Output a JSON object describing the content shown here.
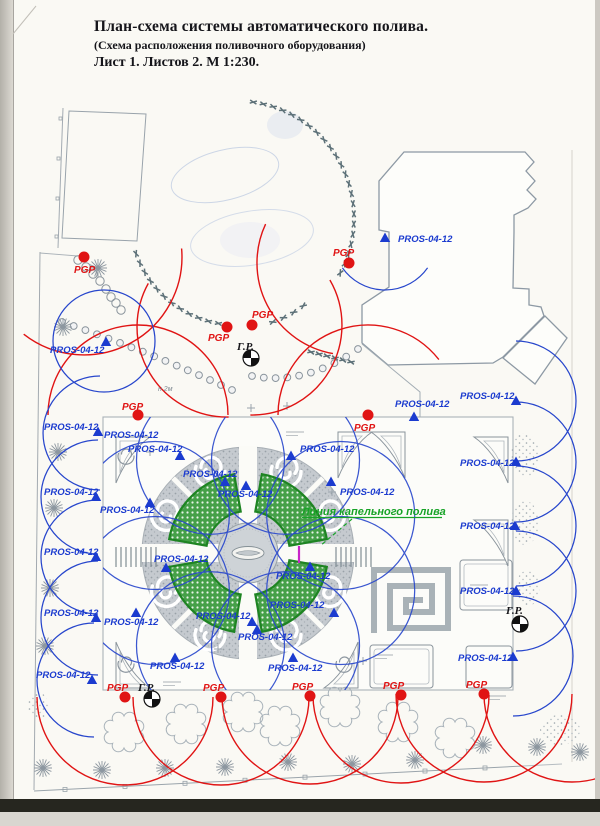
{
  "title": {
    "line1": "План-схема системы автоматического полива.",
    "line2": "(Схема расположения поливочного оборудования)",
    "line3": "Лист 1. Листов 2. М 1:230."
  },
  "labels": {
    "spray": "PROS-04-12",
    "rotor": "PGP",
    "hydrant": "Г.Р.",
    "drip": "Линия капельного полива",
    "hedge_note": "н 2м"
  },
  "colors": {
    "spray_blue": "#1b3bcf",
    "arc_blue": "#2746cc",
    "rotor_red": "#e01414",
    "drip_green": "#17a327",
    "hydrant_black": "#111111",
    "magenta": "#c824c8"
  },
  "markers": {
    "spray_heads": [
      {
        "x": 385,
        "y": 238,
        "lx": 398,
        "ly": 242
      },
      {
        "x": 106,
        "y": 342,
        "lx": 50,
        "ly": 353
      },
      {
        "x": 98,
        "y": 432,
        "lx": 44,
        "ly": 430
      },
      {
        "x": 96,
        "y": 497,
        "lx": 44,
        "ly": 495
      },
      {
        "x": 96,
        "y": 557,
        "lx": 44,
        "ly": 555
      },
      {
        "x": 96,
        "y": 618,
        "lx": 44,
        "ly": 616
      },
      {
        "x": 92,
        "y": 680,
        "lx": 36,
        "ly": 678
      },
      {
        "x": null,
        "y": null,
        "lx": 104,
        "ly": 438
      },
      {
        "x": 180,
        "y": 456,
        "lx": 128,
        "ly": 452
      },
      {
        "x": 225,
        "y": 482,
        "lx": 183,
        "ly": 477
      },
      {
        "x": 246,
        "y": 486,
        "lx": 218,
        "ly": 497
      },
      {
        "x": 291,
        "y": 456,
        "lx": 300,
        "ly": 452
      },
      {
        "x": 331,
        "y": 482,
        "lx": 340,
        "ly": 495
      },
      {
        "x": 150,
        "y": 503,
        "lx": 100,
        "ly": 513
      },
      {
        "x": 166,
        "y": 568,
        "lx": 154,
        "ly": 562
      },
      {
        "x": 310,
        "y": 567,
        "lx": 276,
        "ly": 579
      },
      {
        "x": 334,
        "y": 613,
        "lx": 270,
        "ly": 608
      },
      {
        "x": 252,
        "y": 622,
        "lx": 196,
        "ly": 619
      },
      {
        "x": 136,
        "y": 613,
        "lx": 104,
        "ly": 625
      },
      {
        "x": 257,
        "y": 630,
        "lx": 238,
        "ly": 640
      },
      {
        "x": 175,
        "y": 658,
        "lx": 150,
        "ly": 669
      },
      {
        "x": 293,
        "y": 658,
        "lx": 268,
        "ly": 671
      },
      {
        "x": 516,
        "y": 401,
        "lx": 460,
        "ly": 399
      },
      {
        "x": 414,
        "y": 417,
        "lx": 395,
        "ly": 407
      },
      {
        "x": 516,
        "y": 462,
        "lx": 460,
        "ly": 466
      },
      {
        "x": 515,
        "y": 526,
        "lx": 460,
        "ly": 529
      },
      {
        "x": 516,
        "y": 591,
        "lx": 460,
        "ly": 594
      },
      {
        "x": 513,
        "y": 657,
        "lx": 458,
        "ly": 661
      }
    ],
    "rotor_heads": [
      {
        "x": 84,
        "y": 257,
        "lx": 74,
        "ly": 273
      },
      {
        "x": 349,
        "y": 263,
        "lx": 333,
        "ly": 256
      },
      {
        "x": 227,
        "y": 327,
        "lx": 208,
        "ly": 341
      },
      {
        "x": 252,
        "y": 325,
        "lx": 252,
        "ly": 318
      },
      {
        "x": 138,
        "y": 415,
        "lx": 122,
        "ly": 410
      },
      {
        "x": 368,
        "y": 415,
        "lx": 354,
        "ly": 431
      },
      {
        "x": 125,
        "y": 697,
        "lx": 107,
        "ly": 691
      },
      {
        "x": 221,
        "y": 697,
        "lx": 203,
        "ly": 691
      },
      {
        "x": 310,
        "y": 696,
        "lx": 292,
        "ly": 690
      },
      {
        "x": 401,
        "y": 695,
        "lx": 383,
        "ly": 689
      },
      {
        "x": 484,
        "y": 694,
        "lx": 466,
        "ly": 688
      }
    ],
    "hydrants": [
      {
        "x": 251,
        "y": 358,
        "lx": 237,
        "ly": 350
      },
      {
        "x": 152,
        "y": 699,
        "lx": 138,
        "ly": 691
      },
      {
        "x": 520,
        "y": 624,
        "lx": 506,
        "ly": 614
      }
    ],
    "drip_callout": {
      "lx": 302,
      "ly": 515,
      "underline_w": 140,
      "dash_from": [
        352,
        519
      ],
      "dash_to": [
        320,
        546
      ]
    },
    "hedge_note_pos": {
      "x": 158,
      "y": 391
    }
  }
}
